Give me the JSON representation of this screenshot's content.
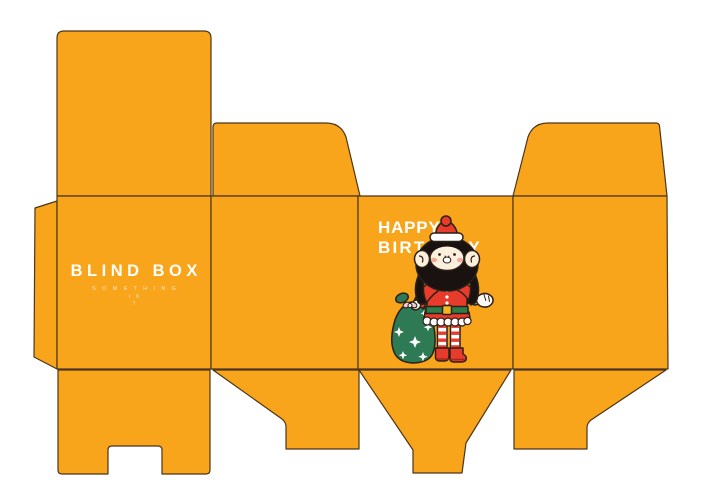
{
  "front_panel": {
    "title": "BLIND BOX",
    "tagline_line1": "S O M E T H I N G",
    "tagline_line2": "I N",
    "tagline_line3": "?"
  },
  "back_panel": {
    "greeting_line1": "HAPPY",
    "greeting_line2": "BIRTHDAY"
  },
  "colors": {
    "box_orange": "#F9A51C",
    "outline": "#4C351A",
    "char_outline": "#2B2016",
    "text_white": "#FFFFFF",
    "santa_red": "#E73B2C",
    "dark_red": "#A4261D",
    "hair_black": "#191210",
    "skin": "#FCF0DC",
    "cheek_pink": "#F3A89D",
    "sack_green": "#2D7A55",
    "belt_green": "#2E7C49",
    "buckle_yellow": "#F1B71E",
    "bow_pink": "#F6CDD3"
  }
}
